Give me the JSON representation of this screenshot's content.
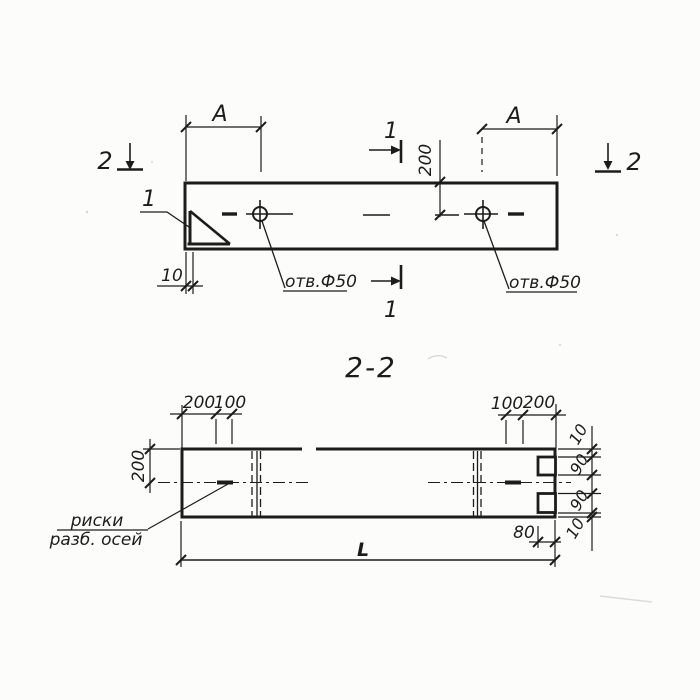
{
  "drawing": {
    "section_title": "2-2",
    "ink_color": "#1c1c1c",
    "plan": {
      "cut_label_1": "1",
      "cut_label_2": "2",
      "gusset_callout": "1",
      "dim_a": "А",
      "dim_axis_offset": "200",
      "dim_gusset_thickness": "10",
      "hole_label": "отв.Ф50"
    },
    "section": {
      "dims_top_left": [
        "200",
        "100"
      ],
      "dims_top_right": [
        "100",
        "200"
      ],
      "dim_height_half": "200",
      "dims_right_edge": [
        "10",
        "90",
        "90",
        "10"
      ],
      "dim_notch_inset": "80",
      "dim_length": "L",
      "axis_marks_line1": "риски",
      "axis_marks_line2": "разб. осей"
    }
  }
}
